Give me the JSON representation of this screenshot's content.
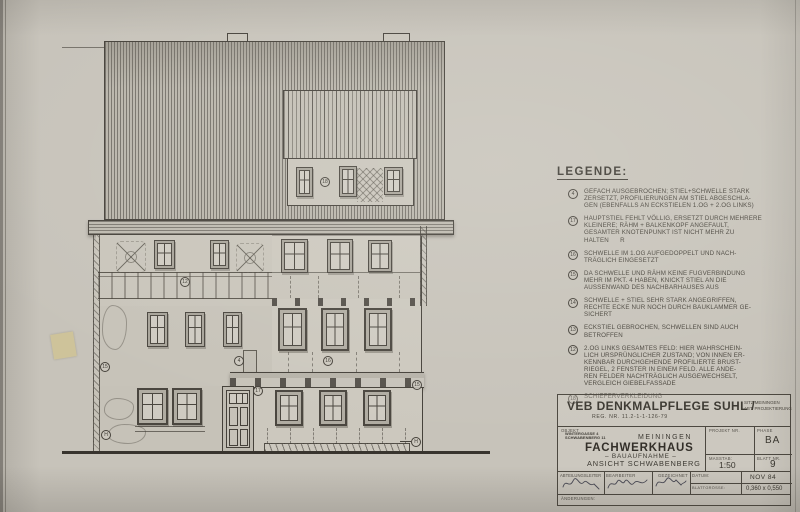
{
  "legend": {
    "title": "LEGENDE:",
    "items": [
      {
        "num": "4",
        "text": "GEFACH AUSGEBROCHEN; STIEL+SCHWELLE STARK\nZERSETZT, PROFILIERUNGEN AM STIEL ABGESCHLA-\nGEN (EBENFALLS AN ECKSTIELEN 1.OG + 2.OG LINKS)"
      },
      {
        "num": "17",
        "text": "HAUPTSTIEL FEHLT VÖLLIG, ERSETZT DURCH MEHRERE\nKLEINERE; RÄHM + BALKENKOPF ANGEFAULT,\nGESAMTER KNOTENPUNKT IST NICHT MEHR ZU\nHALTEN      R"
      },
      {
        "num": "16",
        "text": "SCHWELLE IM 1.OG AUFGEDOPPELT UND NACH-\nTRÄGLICH EINGESETZT"
      },
      {
        "num": "15",
        "text": "DA SCHWELLE UND RÄHM KEINE FUGVERBINDUNG\nMEHR IM PKT. 4 HABEN, KNICKT STIEL AN DIE\nAUSSENWAND DES NACHBARHAUSES AUS"
      },
      {
        "num": "14",
        "text": "SCHWELLE + STIEL SEHR STARK ANGEGRIFFEN,\nRECHTE ECKE NUR NOCH DURCH BAUKLAMMER GE-\nSICHERT"
      },
      {
        "num": "13",
        "text": "ECKSTIEL GEBROCHEN, SCHWELLEN SIND AUCH\nBETROFFEN"
      },
      {
        "num": "12",
        "text": "2.OG LINKS GESAMTES FELD: HIER WAHRSCHEIN-\nLICH URSPRÜNGLICHER ZUSTAND; VON INNEN ER-\nKENNBAR DURCHGEHENDE PROFILIERTE BRUST-\nRIEGEL, 2 FENSTER IN EINEM FELD. ALLE ANDE-\nREN FELDER NACHTRÄGLICH AUSGEWECHSELT,\nVERGLEICH GIEBELFASSADE"
      },
      {
        "num": "18",
        "text": "SCHIEFERVERKLEIDUNG"
      }
    ]
  },
  "drawing": {
    "markers": [
      {
        "label": "18"
      },
      {
        "label": "12"
      },
      {
        "label": "15"
      },
      {
        "label": "4"
      },
      {
        "label": "16"
      },
      {
        "label": "17"
      },
      {
        "label": "15"
      },
      {
        "label": "H"
      },
      {
        "label": "H"
      }
    ]
  },
  "titleblock": {
    "company": "VEB DENKMALPFLEGE SUHL /",
    "sitz": "SITZ MEININGEN",
    "abt": "ABT. PROJEKTIERUNG",
    "reg": "REG. NR. 11.2-1-1-126-79",
    "objekt_label": "OBJEKT",
    "stamp_line1": "WINTERGASSE 4",
    "stamp_line2": "SCHWABENBERG 11",
    "city": "MEININGEN",
    "object_title": "FACHWERKHAUS",
    "object_sub1": "– BAUAUFNAHME –",
    "object_sub2": "ANSICHT SCHWABENBERG",
    "projekt_label": "PROJEKT NR.",
    "phase_label": "PHASE",
    "phase_value": "BA",
    "masstab_label": "MASSTAB:",
    "masstab_value": "1:50",
    "blatt_label": "BLATT NR.",
    "blatt_value": "9",
    "abteilungsleiter_label": "ABTEILUNGSLEITER",
    "bearbeiter_label": "BEARBEITER",
    "gezeichnet_label": "GEZEICHNET",
    "datum_label": "DATUM:",
    "datum_value": "NOV 84",
    "blattgroesse_label": "BLATTGRÖSSE:",
    "blattgroesse_value": "0,360 x 0,550",
    "aenderungen_label": "ÄNDERUNGEN:"
  }
}
